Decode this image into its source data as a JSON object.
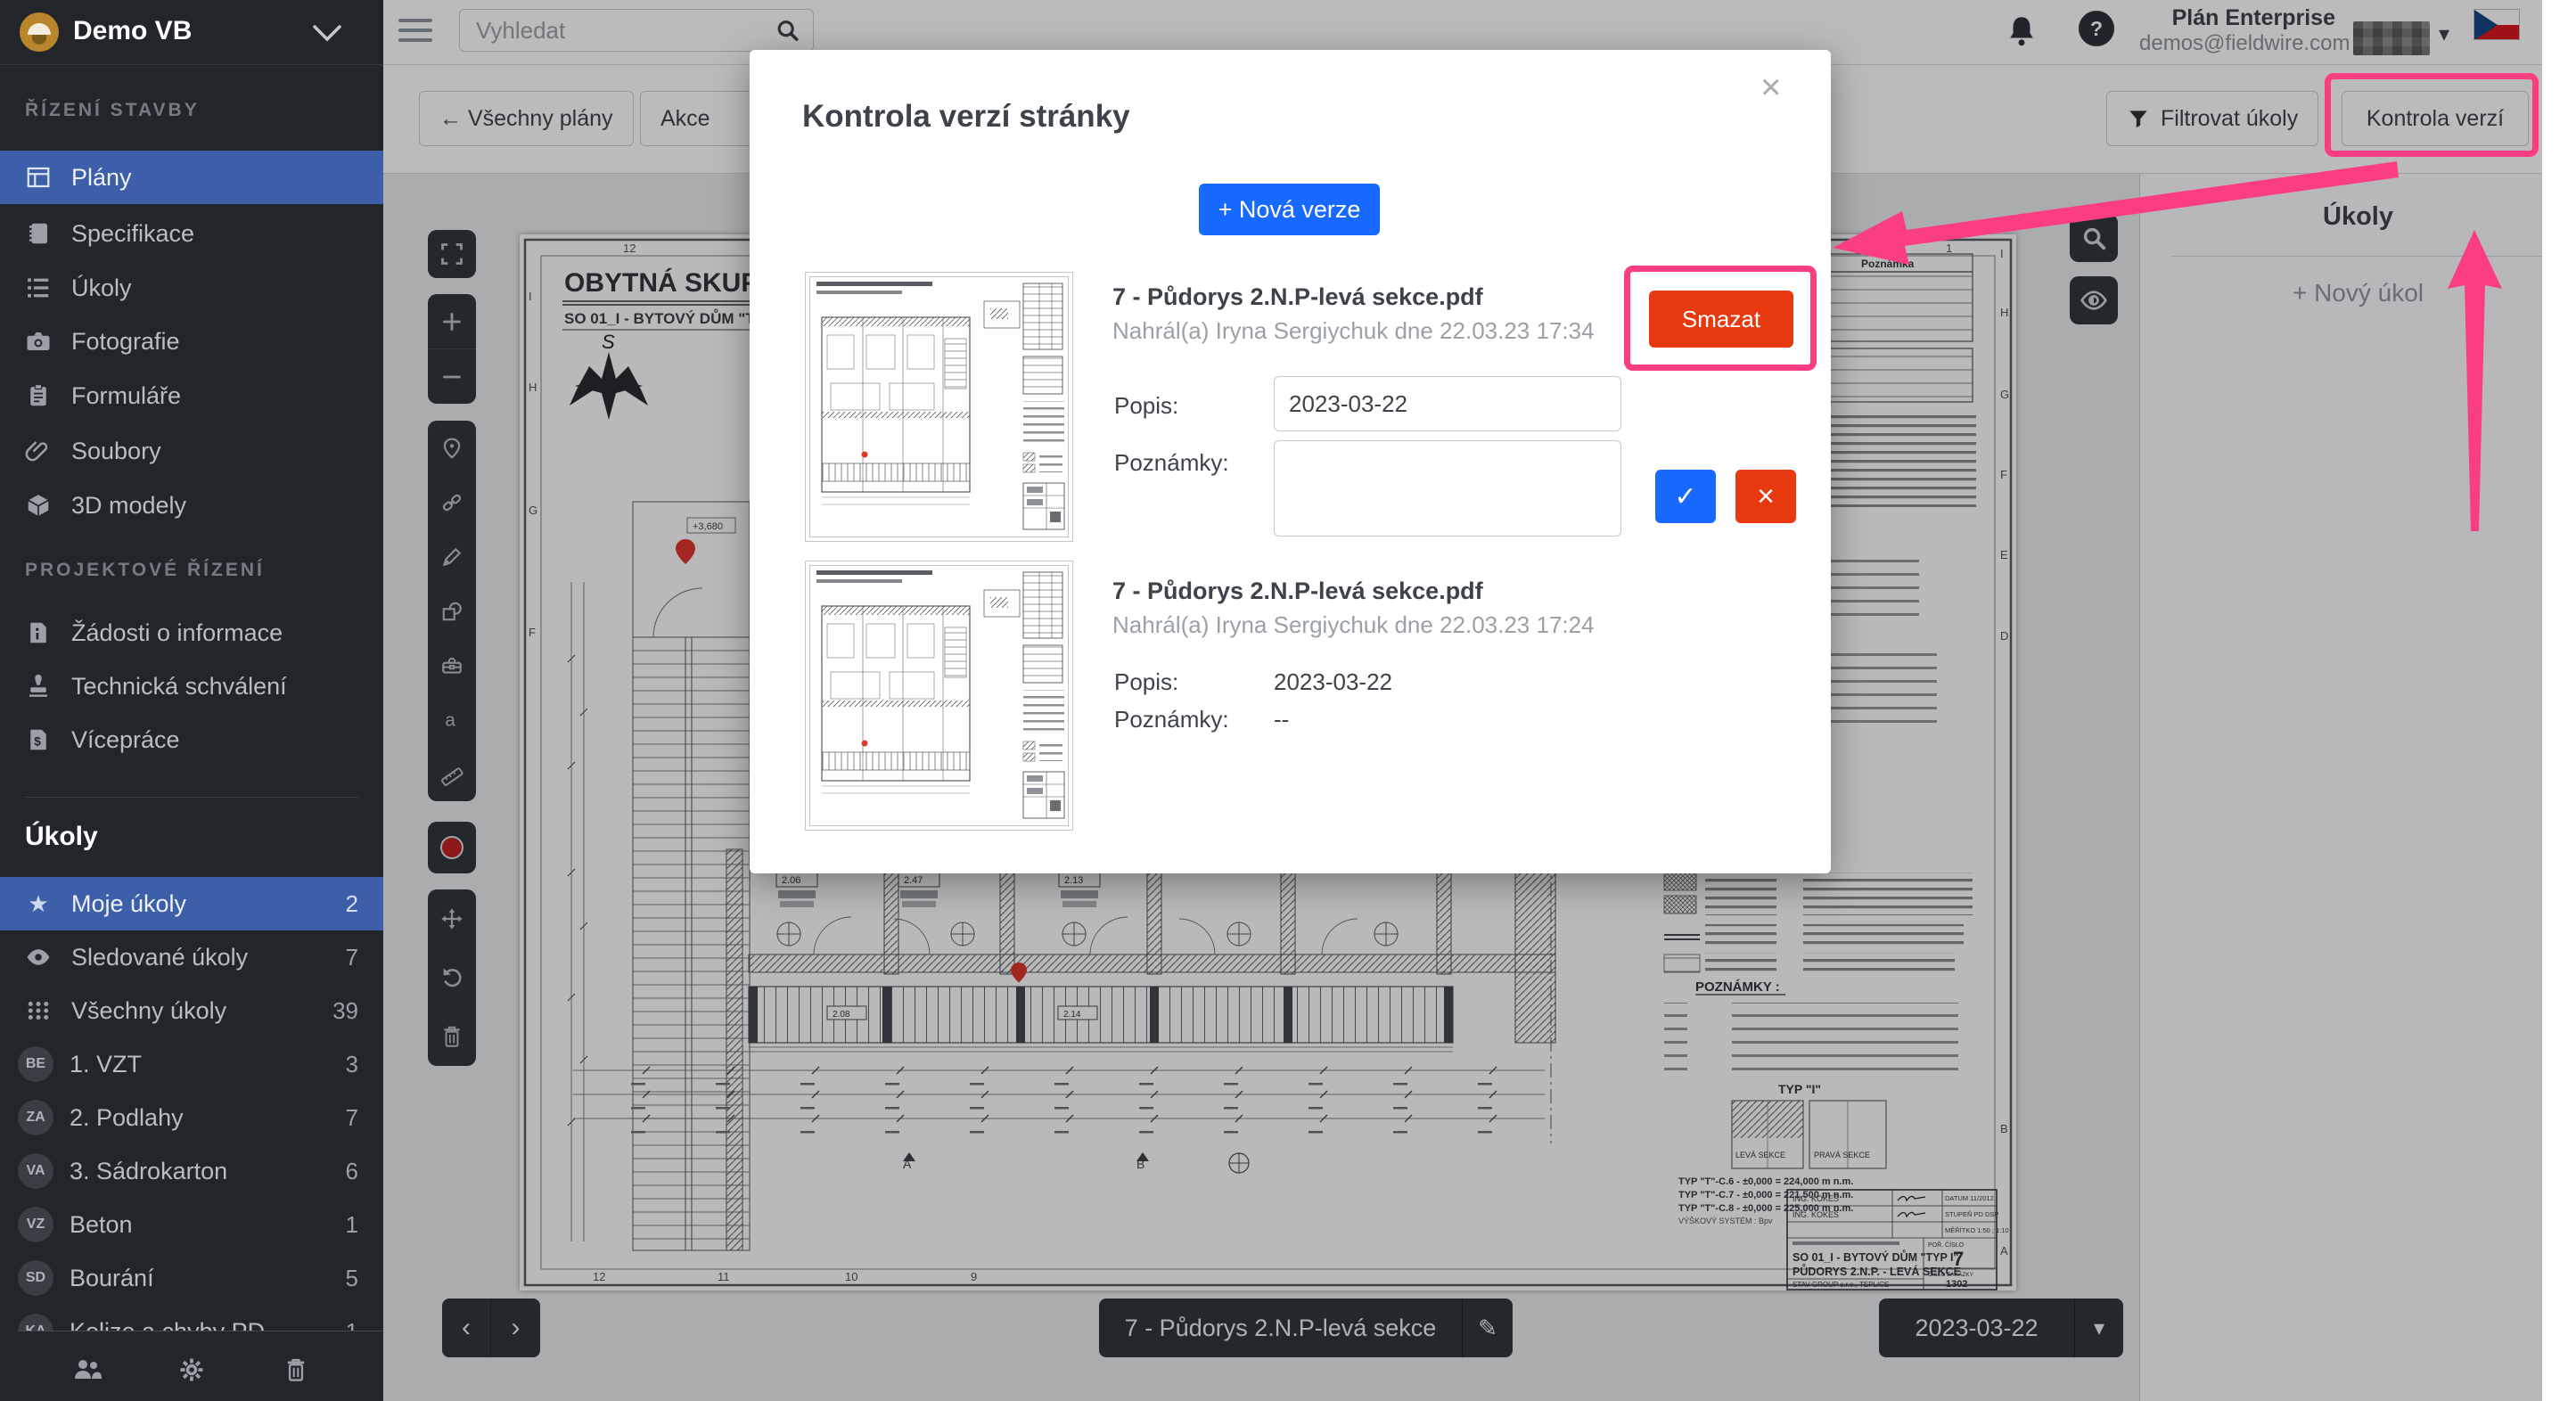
{
  "colors": {
    "accent_blue": "#1769ff",
    "danger_red": "#e8380f",
    "annotation_pink": "#fb3e82",
    "sidebar_selected": "#3d5fa9",
    "sidebar_bg": "#22262b"
  },
  "sidebar": {
    "project_name": "Demo VB",
    "sections": [
      {
        "label": "ŘÍZENÍ STAVBY",
        "items": [
          {
            "label": "Plány"
          },
          {
            "label": "Specifikace"
          },
          {
            "label": "Úkoly"
          },
          {
            "label": "Fotografie"
          },
          {
            "label": "Formuláře"
          },
          {
            "label": "Soubory"
          },
          {
            "label": "3D modely"
          }
        ]
      },
      {
        "label": "PROJEKTOVÉ ŘÍZENÍ",
        "items": [
          {
            "label": "Žádosti o informace"
          },
          {
            "label": "Technická schválení"
          },
          {
            "label": "Vícepráce"
          }
        ]
      }
    ],
    "tasks_header": "Úkoly",
    "filters": [
      {
        "label": "Moje úkoly",
        "count": "2"
      },
      {
        "label": "Sledované úkoly",
        "count": "7"
      },
      {
        "label": "Všechny úkoly",
        "count": "39"
      }
    ],
    "categories": [
      {
        "avatar": "BE",
        "label": "1. VZT",
        "count": "3"
      },
      {
        "avatar": "ZA",
        "label": "2. Podlahy",
        "count": "7"
      },
      {
        "avatar": "VA",
        "label": "3. Sádrokarton",
        "count": "6"
      },
      {
        "avatar": "VZ",
        "label": "Beton",
        "count": "1"
      },
      {
        "avatar": "SD",
        "label": "Bourání",
        "count": "5"
      },
      {
        "avatar": "KA",
        "label": "Kolize a chyby PD",
        "count": "1"
      }
    ]
  },
  "topbar": {
    "search_placeholder": "Vyhledat",
    "plan_label": "Plán Enterprise",
    "account_email": "demos@fieldwire.com",
    "help_glyph": "?"
  },
  "plan_toolbar": {
    "back_label": "← Všechny plány",
    "actions_label": "Akce",
    "filter_label": "Filtrovat úkoly",
    "versions_label": "Kontrola verzí"
  },
  "modal": {
    "title": "Kontrola verzí stránky",
    "close_glyph": "×",
    "new_version_label": "+ Nová verze",
    "check_glyph": "✓",
    "cancel_glyph": "×",
    "versions": [
      {
        "filename": "7 - Půdorys 2.N.P-levá sekce.pdf",
        "uploaded": "Nahrál(a) Iryna Sergiychuk dne 22.03.23 17:34",
        "popis_label": "Popis:",
        "popis_value": "2023-03-22",
        "poznamky_label": "Poznámky:",
        "poznamky_value": "",
        "delete_label": "Smazat"
      },
      {
        "filename": "7 - Půdorys 2.N.P-levá sekce.pdf",
        "uploaded": "Nahrál(a) Iryna Sergiychuk dne 22.03.23 17:24",
        "popis_label": "Popis:",
        "popis_value": "2023-03-22",
        "poznamky_label": "Poznámky:",
        "poznamky_value": "--"
      }
    ]
  },
  "right_panel": {
    "title": "Úkoly",
    "new_task_label": "+ Nový úkol"
  },
  "bottom_bar": {
    "prev_glyph": "‹",
    "next_glyph": "›",
    "plan_name": "7 - Půdorys 2.N.P-levá sekce",
    "edit_glyph": "✎",
    "version_date": "2023-03-22",
    "caret_glyph": "▾"
  },
  "sheet": {
    "title": "OBYTNÁ SKUPINA -",
    "subtitle": "SO 01_I - BYTOVÝ DŮM \"TYP I\" - PŮDORYS 2.N.P.",
    "compass_letter": "S",
    "level_label": "+3,680",
    "room_labels": [
      "2.06",
      "2.47",
      "2.13",
      "2.08",
      "2.14"
    ],
    "grid_numbers_top": [
      "12",
      "11",
      "2",
      "1"
    ],
    "grid_numbers_bottom": [
      "12",
      "11",
      "10",
      "9"
    ],
    "grid_letters_left": [
      "I",
      "H",
      "G",
      "F"
    ],
    "grid_letters_right": [
      "I",
      "H",
      "G",
      "F",
      "E",
      "D",
      "B",
      "A"
    ],
    "section_marks": [
      "A",
      "B"
    ],
    "table_headers": [
      "Povrch",
      "Podhled",
      "Poznámka"
    ],
    "poznamky_label": "POZNÁMKY :",
    "typ_label": "TYP \"I\"",
    "section_cells": [
      "LEVÁ SEKCE",
      "PRAVÁ SEKCE"
    ],
    "levels": [
      "TYP \"T\"-C.6 - ±0,000 = 224,000 m n.m.",
      "TYP \"T\"-C.7 - ±0,000 = 221,500 m n.m.",
      "TYP \"T\"-C.8 - ±0,000 = 225,000 m n.m."
    ],
    "height_system": "VÝŠKOVÝ SYSTÉM : Bpv",
    "titleblock": {
      "engineer": "ING. KOKEŠ",
      "datum": "DATUM  11/2012",
      "stupen": "STUPEŇ PD  DSP",
      "meritko": "MĚŘÍTKO  1:50 ; 1:10",
      "por_label": "POŘ. ČÍSLO",
      "por": "7",
      "building": "SO 01_I - BYTOVÝ DŮM \"TYP I\"",
      "drawing": "PŮDORYS 2.N.P. - LEVÁ SEKCE",
      "zakazka_label": "ČÍSLO ZAKÁZKY",
      "zakazka": "1302",
      "firm": "STAV GROUP s.r.o., TEPLICE"
    }
  }
}
